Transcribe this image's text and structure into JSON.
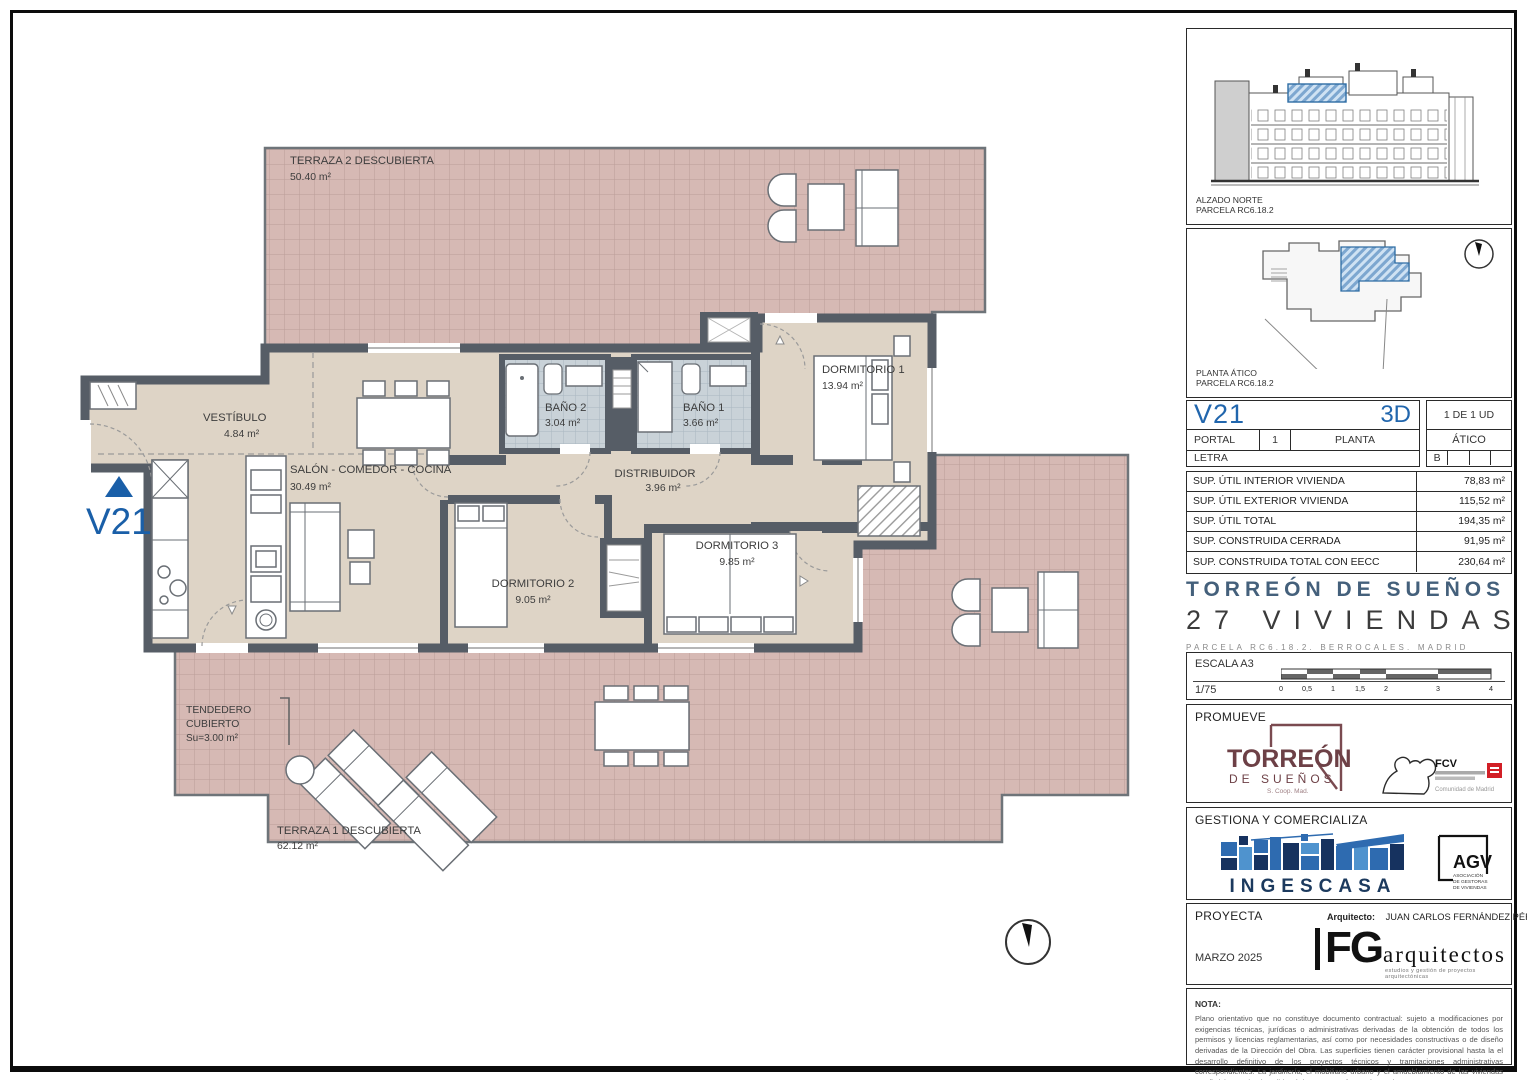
{
  "plan": {
    "marker": "V21",
    "rooms": {
      "terraza2": {
        "name": "TERRAZA 2 DESCUBIERTA",
        "area": "50.40 m²"
      },
      "vestibulo": {
        "name": "VESTÍBULO",
        "area": "4.84 m²"
      },
      "salon": {
        "name": "SALÓN - COMEDOR - COCINA",
        "area": "30.49 m²"
      },
      "bano2": {
        "name": "BAÑO 2",
        "area": "3.04 m²"
      },
      "bano1": {
        "name": "BAÑO 1",
        "area": "3.66 m²"
      },
      "distribuidor": {
        "name": "DISTRIBUIDOR",
        "area": "3.96 m²"
      },
      "dormitorio1": {
        "name": "DORMITORIO 1",
        "area": "13.94 m²"
      },
      "dormitorio2": {
        "name": "DORMITORIO 2",
        "area": "9.05 m²"
      },
      "dormitorio3": {
        "name": "DORMITORIO 3",
        "area": "9.85 m²"
      },
      "tendedero": {
        "line1": "TENDEDERO",
        "line2": "CUBIERTO",
        "area": "Su=3.00 m²"
      },
      "terraza1": {
        "name": "TERRAZA 1 DESCUBIERTA",
        "area": "62.12 m²"
      }
    }
  },
  "panels": {
    "alzado": {
      "title": "ALZADO NORTE",
      "subtitle": "PARCELA RC6.18.2"
    },
    "planta": {
      "title": "PLANTA ÁTICO",
      "subtitle": "PARCELA RC6.18.2"
    }
  },
  "unit": {
    "code": "V21",
    "view": "3D",
    "count": "1 DE 1 UD",
    "portal_label": "PORTAL",
    "portal_value": "1",
    "planta_label": "PLANTA",
    "planta_value": "ÁTICO",
    "letra_label": "LETRA",
    "letra_value": "B"
  },
  "surfaces": {
    "rows": [
      {
        "label": "SUP. ÚTIL INTERIOR VIVIENDA",
        "value": "78,83 m²"
      },
      {
        "label": "SUP. ÚTIL EXTERIOR VIVIENDA",
        "value": "115,52 m²"
      },
      {
        "label": "SUP. ÚTIL TOTAL",
        "value": "194,35 m²"
      },
      {
        "label": "SUP. CONSTRUIDA CERRADA",
        "value": "91,95 m²"
      },
      {
        "label": "SUP. CONSTRUIDA TOTAL CON EECC",
        "value": "230,64 m²"
      }
    ]
  },
  "project": {
    "name": "TORREÓN DE SUEÑOS",
    "units": "27 VIVIENDAS",
    "location": "PARCELA RC6.18.2. BERROCALES. MADRID"
  },
  "escala": {
    "label": "ESCALA A3",
    "ratio": "1/75",
    "ticks": [
      "0",
      "0,5",
      "1",
      "1,5",
      "2",
      "3",
      "4"
    ]
  },
  "promueve": {
    "label": "PROMUEVE",
    "logo_title": "TORREÓN",
    "logo_subtitle": "DE SUEÑOS",
    "logo_coop": "S. Coop. Mad.",
    "fcv": "FCV",
    "cam": "Comunidad de Madrid"
  },
  "gestiona": {
    "label": "GESTIONA Y COMERCIALIZA",
    "ingescasa": "INGESCASA",
    "agv": "AGV",
    "agv_line1": "ASOCIACIÓN",
    "agv_line2": "DE GESTORAS",
    "agv_line3": "DE VIVIENDAS"
  },
  "proyecta": {
    "label": "PROYECTA",
    "architect_label": "Arquitecto:",
    "architect": "JUAN CARLOS FERNÁNDEZ PÉREZ",
    "date": "MARZO 2025",
    "logo_initials": "FG",
    "logo_name": "arquitectos",
    "logo_tagline": "estudios y gestión de proyectos arquitectónicas"
  },
  "nota": {
    "label": "NOTA:",
    "text": "Plano orientativo que no constituye documento contractual: sujeto a modificaciones por exigencias técnicas, jurídicas o administrativas derivadas de la obtención de todos los permisos y licencias reglamentarias, así como por necesidades constructivas o de diseño derivadas de la Dirección del Obra. Las superficies tienen carácter provisional hasta la el desarrollo definitivo de los proyectos técnicos y tramitaciones administrativas correspondientes. La jardinería, el mobiliario urbano y el amueblamiento de las viviendas son ficticios, teniendo validez únicamente a efectos decorativos."
  }
}
